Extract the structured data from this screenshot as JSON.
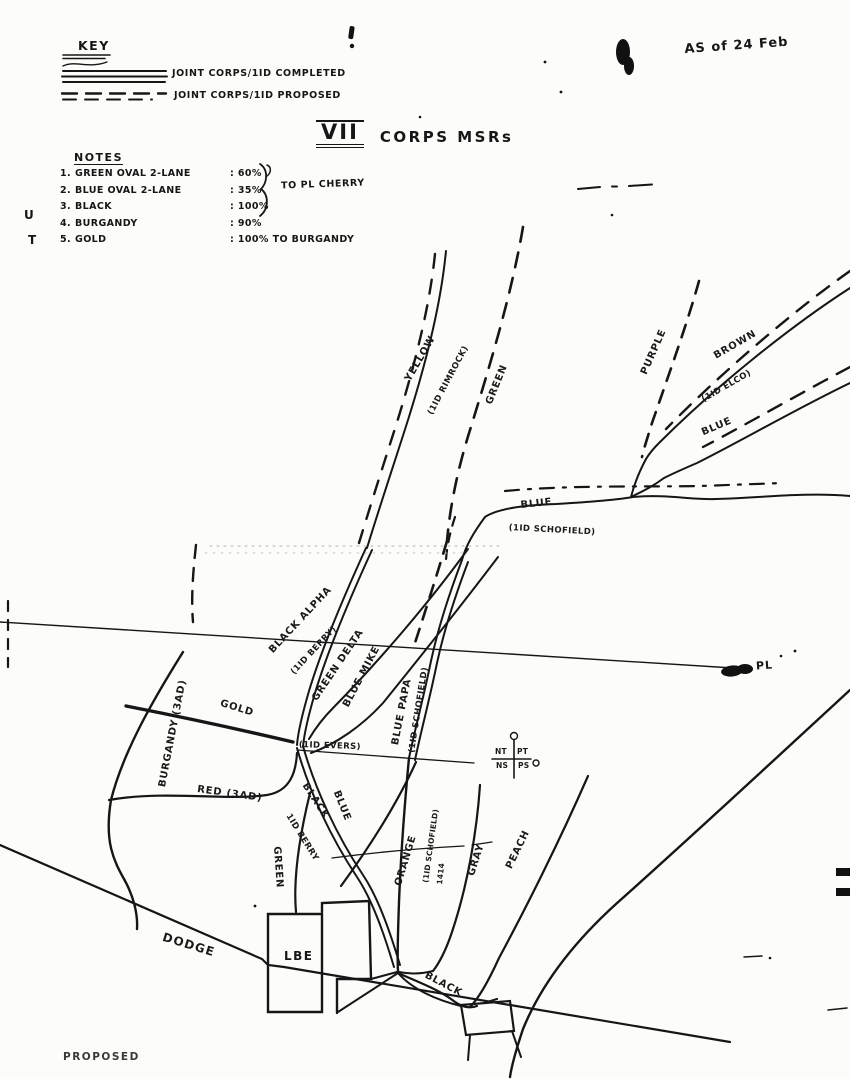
{
  "header": {
    "key_heading": "KEY",
    "key_completed_label": "JOINT CORPS/1ID COMPLETED",
    "key_proposed_label": "JOINT CORPS/1ID PROPOSED",
    "title_numeral": "VII",
    "title_text": "CORPS MSRs",
    "date_note": "AS of 24 Feb"
  },
  "notes": {
    "heading": "NOTES",
    "brace_label": "TO PL CHERRY",
    "rows": [
      {
        "num": "1.",
        "name": "GREEN OVAL 2-LANE",
        "value": ": 60%"
      },
      {
        "num": "2.",
        "name": "BLUE OVAL 2-LANE",
        "value": ": 35%"
      },
      {
        "num": "3.",
        "name": "BLACK",
        "value": ": 100%"
      },
      {
        "num": "4.",
        "name": "BURGANDY",
        "value": ": 90%"
      },
      {
        "num": "5.",
        "name": "GOLD",
        "value": ": 100% TO BURGANDY"
      }
    ]
  },
  "margin": {
    "letter_u": "U",
    "letter_t": "T"
  },
  "map": {
    "yellow": "YELLOW",
    "rimrock": "(1ID RIMROCK)",
    "green_top": "GREEN",
    "purple": "PURPLE",
    "brown": "BROWN",
    "elco": "(1ID ELCO)",
    "blue_top_right": "BLUE",
    "blue_mid": "BLUE",
    "schofield_mid": "(1ID SCHOFIELD)",
    "black_alpha": "BLACK ALPHA",
    "berry_mid": "(1ID BERRY)",
    "green_delta": "GREEN DELTA",
    "blue_mike": "BLUE MIKE",
    "blue_papa": "BLUE PAPA",
    "schofield_papa": "(1ID SCHOFIELD)",
    "phase_line": "PL",
    "burgandy": "BURGANDY (3AD)",
    "gold": "GOLD",
    "red": "RED (3AD)",
    "evers": "(1ID EVERS)",
    "black_lower": "BLACK",
    "berry_lower": "1ID BERRY",
    "blue_lower": "BLUE",
    "green_lower": "GREEN",
    "orange": "ORANGE",
    "schofield_lower": "(1ID SCHOFIELD)",
    "route_marks": "1414",
    "gray": "GRAY",
    "peach": "PEACH",
    "dodge": "DODGE",
    "lbe": "LBE",
    "black_bottom": "BLACK"
  },
  "boundary_symbol": {
    "nt": "NT",
    "pt": "PT",
    "ns": "NS",
    "ps": "PS"
  },
  "footer": {
    "partial_text": "PROPOSED"
  },
  "ink_color": "#161616"
}
